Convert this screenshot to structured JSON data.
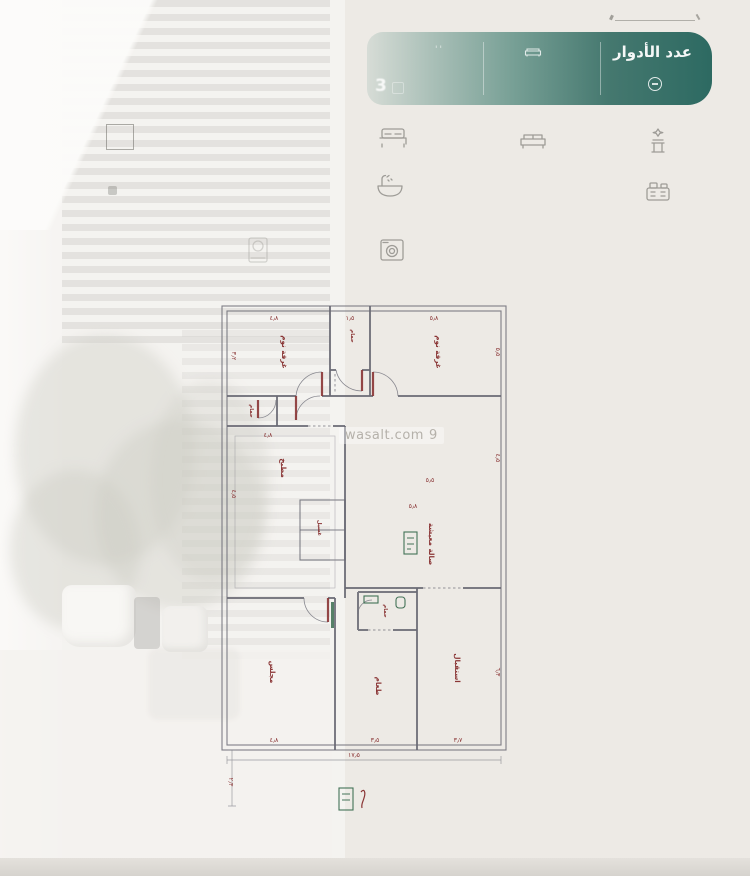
{
  "banner": {
    "title": "عدد الأدوار",
    "rooms_value": "3",
    "quotes": "''",
    "color_dark": "#2d6a62",
    "color_light": "#a3bcb4"
  },
  "watermark": {
    "text": "wasalt.com",
    "logo": "9"
  },
  "plan": {
    "labels": {
      "bedroom1": "غرفة نوم",
      "bedroom2": "غرفة نوم",
      "bath_top": "حمام",
      "bath_left": "حمام",
      "bath_mid": "حمام",
      "kitchen": "مطبخ",
      "hall": "صالة معيشة",
      "laundry": "غسيل",
      "majlis": "مجلس",
      "dining": "طعام",
      "reception": "استقبال"
    },
    "dims": {
      "top1": "٤٫٨",
      "top2": "١٫٥",
      "top3": "٥٫٨",
      "bottom1": "٤٫٨",
      "bottom2": "٣٫٥",
      "bottom3": "٣٫٧",
      "total_width": "١٧٫٥",
      "left1": "٣٫٢",
      "left2": "٤٫٥",
      "left_ext": "٢٫٣",
      "right1": "٥٫٥",
      "right2": "٤٫٥",
      "right3": "٦٫٣",
      "kitchen_w": "٤٫٨",
      "hall_w": "٥٫٨",
      "hall_h": "٥٫٥"
    },
    "wall_color": "#6a6a74",
    "label_color": "#8a3535",
    "stamp_color": "#3a6b4f"
  }
}
